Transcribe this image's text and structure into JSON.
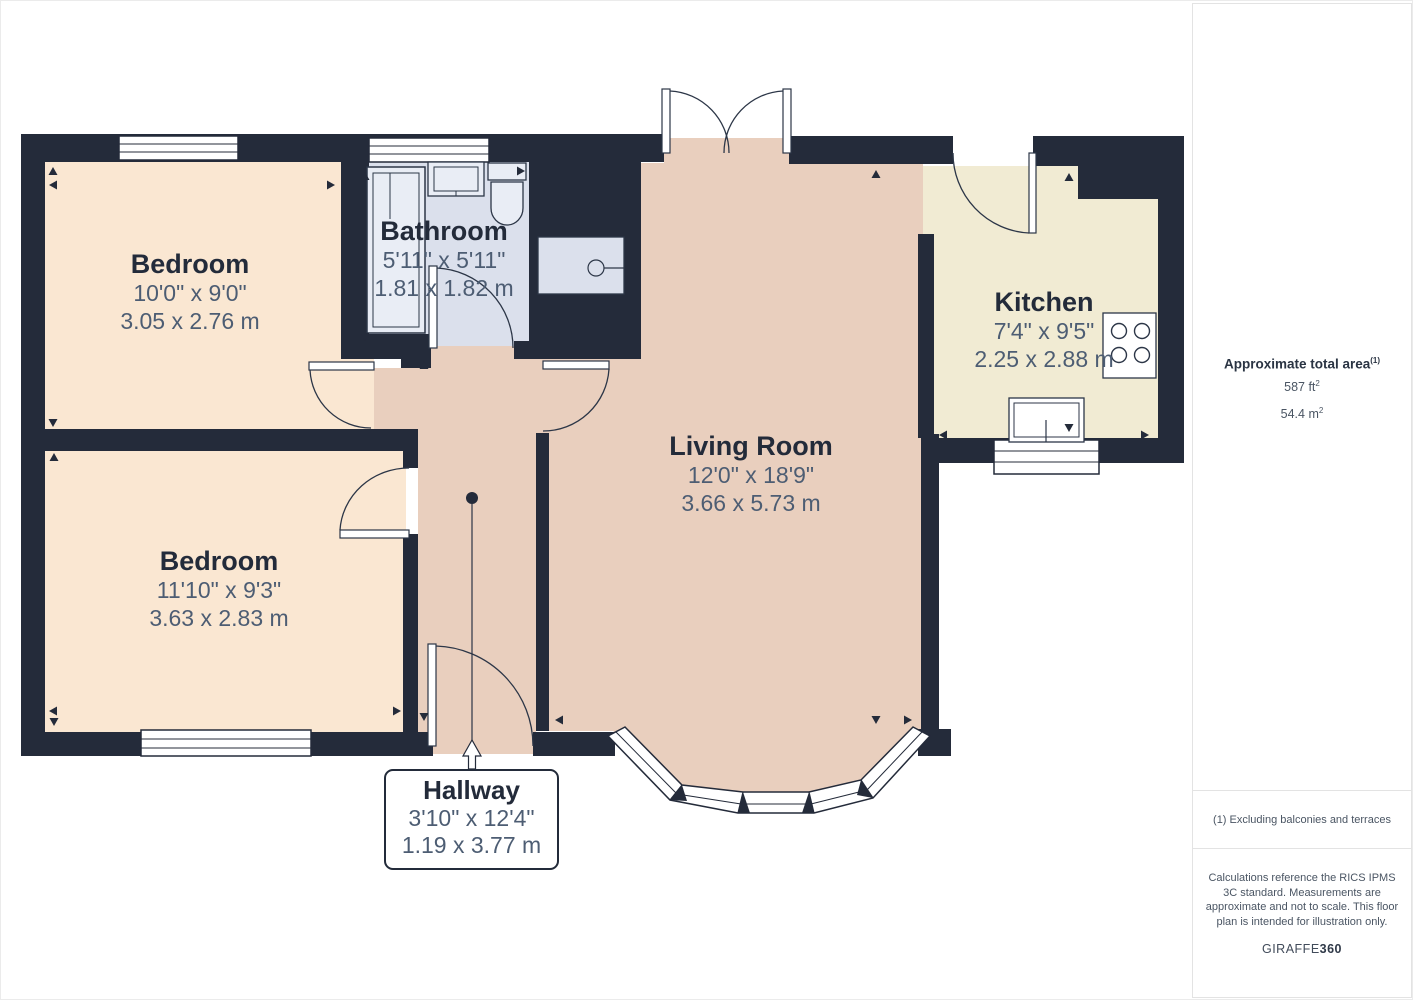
{
  "plan": {
    "rooms": [
      {
        "key": "bedroom-1",
        "name": "Bedroom",
        "imperial": "10'0\" x 9'0\"",
        "metric": "3.05 x 2.76 m"
      },
      {
        "key": "bathroom",
        "name": "Bathroom",
        "imperial": "5'11\" x 5'11\"",
        "metric": "1.81 x 1.82 m"
      },
      {
        "key": "living-room",
        "name": "Living Room",
        "imperial": "12'0\" x 18'9\"",
        "metric": "3.66 x 5.73 m"
      },
      {
        "key": "kitchen",
        "name": "Kitchen",
        "imperial": "7'4\" x 9'5\"",
        "metric": "2.25 x 2.88 m"
      },
      {
        "key": "bedroom-2",
        "name": "Bedroom",
        "imperial": "11'10\" x 9'3\"",
        "metric": "3.63 x 2.83 m"
      },
      {
        "key": "hallway",
        "name": "Hallway",
        "imperial": "3'10\" x 12'4\"",
        "metric": "1.19 x 3.77 m"
      }
    ],
    "colors": {
      "wall": "#242b3a",
      "bedroom_fill": "#fae7d2",
      "living_hall_fill": "#e9cfbe",
      "kitchen_fill": "#f1ebd3",
      "bathroom_fill": "#dbe0ec",
      "fixture_fill": "#e9edf5",
      "room_name_text": "#232b3a",
      "room_dim_text": "#4d5d73"
    }
  },
  "sidebar": {
    "title": "Approximate total area",
    "title_note": "(1)",
    "area_ft": "587 ft",
    "area_ft_sup": "2",
    "area_m": "54.4 m",
    "area_m_sup": "2",
    "footnote": "(1) Excluding balconies and terraces",
    "disclaimer": "Calculations reference the RICS IPMS 3C standard. Measurements are approximate and not to scale. This floor plan is intended for illustration only.",
    "brand_name": "GIRAFFE",
    "brand_number": "360"
  }
}
